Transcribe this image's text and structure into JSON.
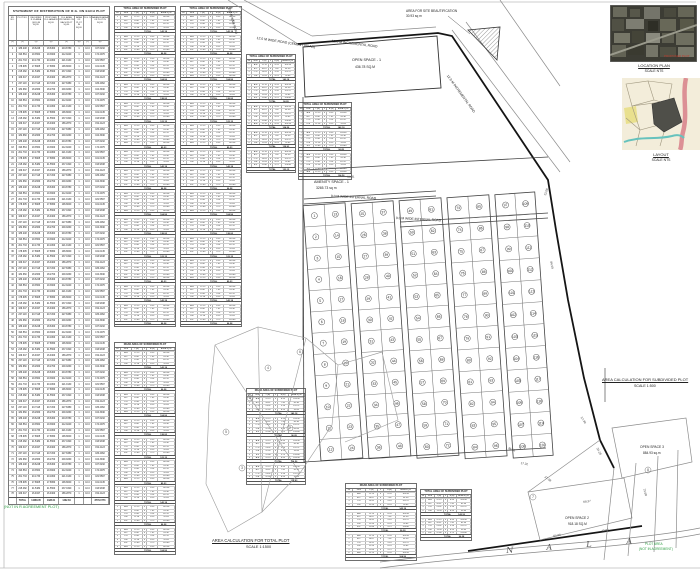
{
  "sheet": {
    "bg": "#ffffff"
  },
  "left_table": {
    "title": "STATEMENT OF DISTRIBUTION OF R.G. ON EACH PLOT",
    "headers": [
      "SR. NO.",
      "PLOT NO.",
      "REQUIRED R.G. AREA (10%) IN SQ.M.",
      "PROPOSED R.G. AREA IN SQ.M.",
      "R.G. AREA PROVIDED ON EACH PLOT SQ.M.",
      "AREA OF PLOT IN SQ.M.",
      "R.G. %",
      "BALANCE AREA OF PLOT IN SQ.M."
    ],
    "units": [
      "(1)",
      "(2)",
      "(3)",
      "(4)",
      "(5)",
      "(6)",
      "(7)",
      "(8)"
    ],
    "col_widths": [
      8,
      12,
      15,
      15,
      16,
      9,
      8,
      17
    ],
    "rows_count": 78,
    "row_variants": [
      [
        "186.248",
        "18.6248",
        "18.6300",
        "204.8780",
        "1",
        "10.0",
        "167.6232"
      ],
      [
        "193.564",
        "19.3564",
        "19.3600",
        "212.9240",
        "1",
        "10.0",
        "174.2076"
      ],
      [
        "201.733",
        "20.1733",
        "20.1800",
        "221.9130",
        "1",
        "10.0",
        "181.5597"
      ],
      [
        "178.905",
        "17.8905",
        "17.8950",
        "196.8000",
        "1",
        "10.0",
        "161.0145"
      ],
      [
        "215.482",
        "21.5482",
        "21.5500",
        "237.0320",
        "1",
        "10.0",
        "193.9338"
      ],
      [
        "169.347",
        "16.9347",
        "16.9400",
        "186.2870",
        "1",
        "10.0",
        "152.4123"
      ],
      [
        "207.118",
        "20.7118",
        "20.7200",
        "227.8380",
        "1",
        "10.0",
        "186.4062"
      ],
      [
        "182.660",
        "18.2660",
        "18.2700",
        "200.9260",
        "1",
        "10.0",
        "164.3940"
      ]
    ],
    "total_row": [
      "",
      "TOTAL",
      "14286.05",
      "1428.61",
      "1432.84",
      "",
      "",
      "8779.0773"
    ]
  },
  "stacks": {
    "headers": [
      "SR",
      "SIDE",
      "L (M)",
      "x",
      "B (M)",
      "AREA SQ.M"
    ],
    "col_widths": [
      10,
      18,
      18,
      8,
      18,
      28
    ],
    "row_variants": [
      [
        "A-B",
        "12.19",
        "x",
        "8.53",
        "103.98"
      ],
      [
        "B-C",
        "10.67",
        "x",
        "7.62",
        "81.30"
      ],
      [
        "C-D",
        "13.41",
        "x",
        "9.14",
        "122.57"
      ],
      [
        "D-E",
        "11.28",
        "x",
        "8.23",
        "92.83"
      ],
      [
        "E-F",
        "12.80",
        "x",
        "9.75",
        "124.80"
      ]
    ],
    "total_label": "TOTAL",
    "total_values": [
      "142.18",
      "96.28",
      "104.56",
      "138.93",
      "123.15",
      "89.23"
    ],
    "list": [
      {
        "id": "A",
        "title": "TOTAL AREA OF SUBDIVIDED PLOT",
        "x": 114,
        "y": 6,
        "w": 62,
        "blocks": 14
      },
      {
        "id": "B",
        "title": "TOTAL AREA OF SUBDIVIDED PLOT",
        "x": 180,
        "y": 6,
        "w": 62,
        "blocks": 14
      },
      {
        "id": "C",
        "title": "TOTAL AREA OF SUBDIVIDED PLOT",
        "x": 246,
        "y": 54,
        "w": 50,
        "blocks": 5
      },
      {
        "id": "D",
        "title": "TOTAL AREA OF SUBDIVIDED PLOT",
        "x": 298,
        "y": 102,
        "w": 54,
        "blocks": 3
      },
      {
        "id": "E",
        "title": "ROAD AREA OF SUBDIVIDED PLOT",
        "x": 114,
        "y": 342,
        "w": 62,
        "blocks": 9
      },
      {
        "id": "F",
        "title": "ROAD AREA OF SUBDIVIDED PLOT",
        "x": 246,
        "y": 388,
        "w": 60,
        "blocks": 4
      },
      {
        "id": "G",
        "title": "ROAD AREA OF SUBDIVIDED PLOT",
        "x": 345,
        "y": 483,
        "w": 72,
        "blocks": 3
      },
      {
        "id": "H",
        "title": "TOTAL AREA OF SUBDIVIDED PLOT",
        "x": 420,
        "y": 489,
        "w": 52,
        "blocks": 2
      }
    ]
  },
  "map": {
    "labels": [
      {
        "t": "AREA FOR SITE BEAUTIFICATION",
        "x": 406,
        "y": 9,
        "s": 3.2
      },
      {
        "t": "30.93 sq m",
        "x": 406,
        "y": 13.6,
        "s": 3.2
      },
      {
        "t": "12.0 M WIDE ROAD (CEMENT ROAD)",
        "x": 257,
        "y": 36,
        "s": 3.4,
        "r": 9
      },
      {
        "t": "12.0 M INCREMENTAL ROAD",
        "x": 332,
        "y": 39,
        "s": 3.4,
        "r": 7
      },
      {
        "t": "12.0 M INCREMENTAL ROAD",
        "x": 449,
        "y": 74,
        "s": 3.4,
        "r": 54
      },
      {
        "t": "12.0 M WIDE ROAD",
        "x": 231,
        "y": 7,
        "s": 3,
        "r": 74
      },
      {
        "t": "OPEN SPACE - 1",
        "x": 352,
        "y": 58,
        "s": 3.7
      },
      {
        "t": "436.78 SQ.M",
        "x": 355,
        "y": 64.5,
        "s": 3.4
      },
      {
        "t": "AMENITY SPACE - 1",
        "x": 314,
        "y": 180,
        "s": 3.7
      },
      {
        "t": "3265.73 sq m",
        "x": 316,
        "y": 186,
        "s": 3.4
      },
      {
        "t": "9.0 M WIDE INTERNAL ROAD",
        "x": 331,
        "y": 193.5,
        "s": 3.3,
        "r": 3
      },
      {
        "t": "9.0 M WIDE INTERNAL ROAD",
        "x": 396,
        "y": 215.5,
        "s": 3.3,
        "r": 3
      },
      {
        "t": "AREA CALCULATION FOR SUBDIVIDED PLOT",
        "x": 602,
        "y": 377,
        "s": 4,
        "u": 1
      },
      {
        "t": "SCALE 1:500",
        "x": 634,
        "y": 383.5,
        "s": 3.6
      },
      {
        "t": "AREA CALCULATION FOR TOTAL PLOT",
        "x": 212,
        "y": 538,
        "s": 4.2,
        "u": 1
      },
      {
        "t": "SCALE 1:1500",
        "x": 246,
        "y": 545,
        "s": 3.8
      },
      {
        "t": "OPEN SPACE 3",
        "x": 640,
        "y": 445,
        "s": 3.3
      },
      {
        "t": "884.93 sq.m",
        "x": 643,
        "y": 450.5,
        "s": 3.2
      },
      {
        "t": "OPEN SPACE 2",
        "x": 565,
        "y": 516,
        "s": 3.3
      },
      {
        "t": "918.18 SQ.M",
        "x": 568,
        "y": 521.5,
        "s": 3.2
      },
      {
        "t": "N",
        "x": 506,
        "y": 546,
        "s": 8,
        "r": -4,
        "f": 1,
        "c": "#555555"
      },
      {
        "t": "A",
        "x": 546,
        "y": 543,
        "s": 8,
        "r": -4,
        "f": 1,
        "c": "#555555"
      },
      {
        "t": "L",
        "x": 586,
        "y": 540,
        "s": 8,
        "r": -4,
        "f": 1,
        "c": "#555555"
      },
      {
        "t": "A",
        "x": 626,
        "y": 537,
        "s": 8,
        "r": -4,
        "f": 1,
        "c": "#555555"
      },
      {
        "t": "(NOT IN R AGREEMENT PLOT)",
        "x": 4,
        "y": 505,
        "s": 3.8,
        "c": "#2f9e44"
      },
      {
        "t": "PLOT AREA",
        "x": 645,
        "y": 542,
        "s": 3.2,
        "c": "#2f9e44"
      },
      {
        "t": "(NOT IN AGREEMENT)",
        "x": 639,
        "y": 547,
        "s": 3.2,
        "c": "#2f9e44"
      },
      {
        "t": "54.31",
        "x": 347,
        "y": 175,
        "s": 3,
        "c": "#444444",
        "r": -3
      },
      {
        "t": "13.08",
        "x": 543,
        "y": 195,
        "s": 3,
        "c": "#444444",
        "r": -72
      },
      {
        "t": "84.59",
        "x": 553,
        "y": 261,
        "s": 3,
        "c": "#444444",
        "r": 78
      },
      {
        "t": "36.68",
        "x": 509,
        "y": 446,
        "s": 3,
        "c": "#444444",
        "r": 22
      },
      {
        "t": "17.32",
        "x": 521,
        "y": 461,
        "s": 3,
        "c": "#444444",
        "r": 10
      },
      {
        "t": "37.08",
        "x": 546,
        "y": 475,
        "s": 3,
        "c": "#444444",
        "r": 36
      },
      {
        "t": "57.99",
        "x": 583,
        "y": 416,
        "s": 3,
        "c": "#444444",
        "r": 56
      },
      {
        "t": "34.28",
        "x": 599,
        "y": 447,
        "s": 3,
        "c": "#444444",
        "r": 62
      },
      {
        "t": "73.68",
        "x": 646,
        "y": 488,
        "s": 3,
        "c": "#444444",
        "r": 74
      },
      {
        "t": "68.37",
        "x": 583,
        "y": 500,
        "s": 3,
        "c": "#444444",
        "r": -8
      },
      {
        "t": "64.66",
        "x": 553,
        "y": 534,
        "s": 3,
        "c": "#444444",
        "r": -9
      },
      {
        "t": "43.60",
        "x": 601,
        "y": 529,
        "s": 3,
        "c": "#444444",
        "r": -9
      }
    ],
    "plot_bands": [
      {
        "x": 312,
        "y": 204,
        "w": 42,
        "rows": 12,
        "cols": 2,
        "rowH": 21.3,
        "start": 1,
        "rot": -4
      },
      {
        "x": 360,
        "y": 202,
        "w": 42,
        "rows": 12,
        "cols": 2,
        "rowH": 21.3,
        "start": 25,
        "rot": -4
      },
      {
        "x": 408,
        "y": 199,
        "w": 42,
        "rows": 12,
        "cols": 2,
        "rowH": 21.5,
        "start": 49,
        "rot": -4
      },
      {
        "x": 456,
        "y": 196,
        "w": 42,
        "rows": 12,
        "cols": 2,
        "rowH": 21.8,
        "start": 73,
        "rot": -4
      },
      {
        "x": 504,
        "y": 193,
        "w": 40,
        "rows": 12,
        "cols": 2,
        "rowH": 22,
        "start": 97,
        "rot": -4
      }
    ],
    "figure_circles": [
      {
        "n": "4",
        "x": 268,
        "y": 368
      },
      {
        "n": "1",
        "x": 250,
        "y": 398
      },
      {
        "n": "2",
        "x": 290,
        "y": 428
      },
      {
        "n": "5",
        "x": 226,
        "y": 432
      },
      {
        "n": "3",
        "x": 242,
        "y": 468
      },
      {
        "n": "6",
        "x": 300,
        "y": 352
      },
      {
        "n": "7",
        "x": 533,
        "y": 497
      },
      {
        "n": "8",
        "x": 648,
        "y": 470
      }
    ]
  },
  "sidebar": {
    "location": {
      "title": "LOCATION PLAN",
      "scale": "SCALE NTS",
      "annotation": "PROPOSED PLOT",
      "annotation_color": "#c0392b"
    },
    "layout": {
      "title": "LAYOUT",
      "scale": "SCALE NTS"
    }
  }
}
